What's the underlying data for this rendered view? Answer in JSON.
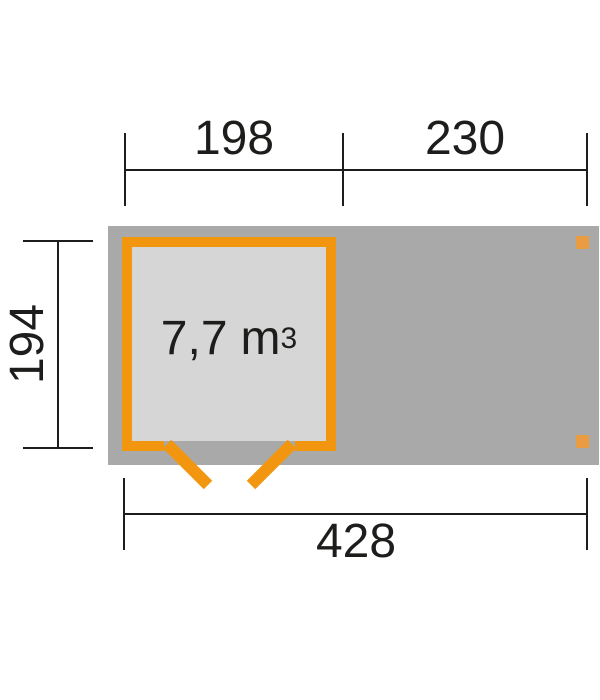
{
  "diagram": {
    "volume": {
      "value": "7,7",
      "unit": "m",
      "exponent": "3"
    },
    "dimensions": {
      "top_left": "198",
      "top_right": "230",
      "left": "194",
      "bottom": "428"
    },
    "colors": {
      "footprint_gray": "#a9a9a9",
      "room_fill_gray": "#d6d6d6",
      "outline_orange": "#f2960f",
      "post_orange": "#e99c42",
      "dimension_black": "#1d1d1b"
    }
  }
}
